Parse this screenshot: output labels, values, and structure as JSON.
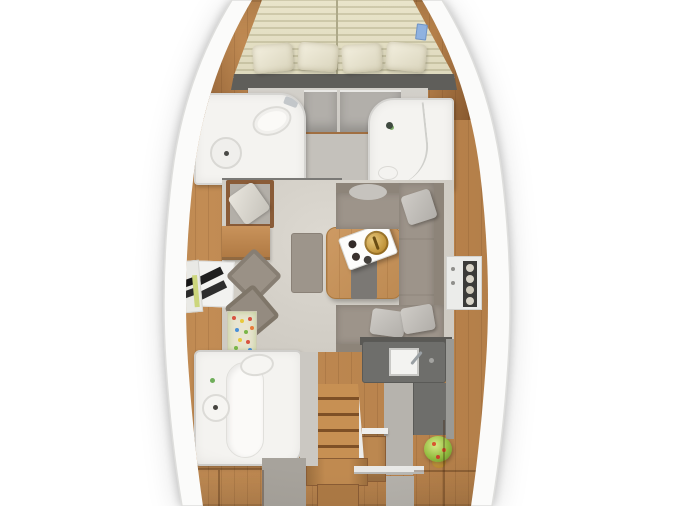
{
  "scene": {
    "type": "sailing-yacht interior floor plan, top-down 3D render",
    "orientation": "bow-up",
    "visible_text": ""
  },
  "palette": {
    "background": "#ffffff",
    "hull_white": "#fbfbfa",
    "hull_edge": "#dededc",
    "teak": "#b5804a",
    "teak_dark": "#8a5c34",
    "floor_grey": "#d7d3cb",
    "mattress": "#e7e2c8",
    "mattress_stripe": "#d3cfae",
    "pillow_light": "#f0ecdc",
    "upholstery": "#9d948a",
    "cushion_grey": "#c6c3be",
    "bath_white": "#f4f3f0",
    "counter_dark": "#6e6e6b",
    "wood_table": "#c4915c",
    "gold": "#c9a23e",
    "plant_green": "#93bc40",
    "book_blue": "#8fb2e0",
    "shelf_yellow": "#ccd67c"
  },
  "rooms": {
    "forward_cabin": {
      "label": "Forward cabin (V-berth)"
    },
    "port_head": {
      "label": "Forward head (port)"
    },
    "starboard_head": {
      "label": "Forward shower room (starboard)"
    },
    "salon": {
      "label": "Salon"
    },
    "nav_station": {
      "label": "Chart table / nav station"
    },
    "galley": {
      "label": "Galley"
    },
    "companionway": {
      "label": "Companionway steps"
    },
    "aft_head": {
      "label": "Aft head with shower"
    },
    "aft_cabin": {
      "label": "Aft cabin"
    }
  }
}
